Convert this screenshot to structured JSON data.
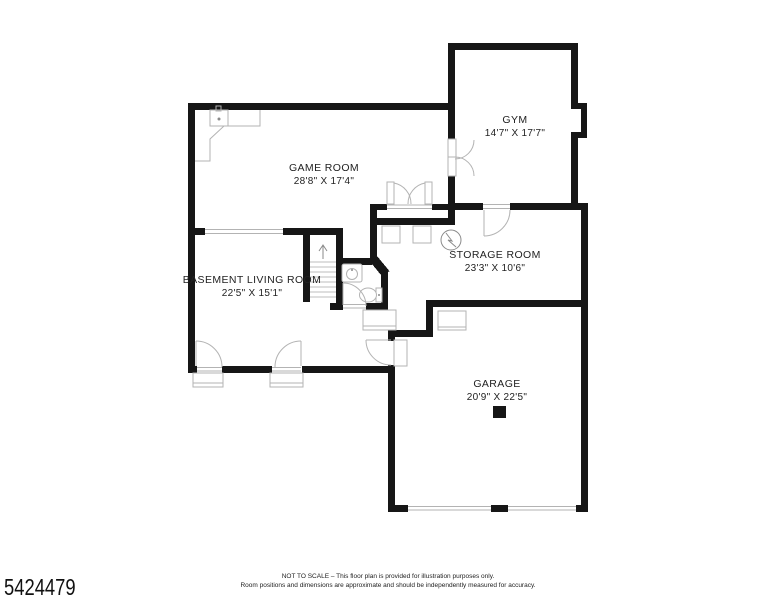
{
  "plan": {
    "title": "Basement / garage floor plan",
    "wall_color": "#161616",
    "fixture_color": "#b3b3b3",
    "rooms": [
      {
        "id": "gym",
        "name": "GYM",
        "dimensions": "14'7\" X 17'7\""
      },
      {
        "id": "game-room",
        "name": "GAME ROOM",
        "dimensions": "28'8\" X 17'4\""
      },
      {
        "id": "storage-room",
        "name": "STORAGE ROOM",
        "dimensions": "23'3\" X 10'6\""
      },
      {
        "id": "basement-living-room",
        "name": "BASEMENT LIVING ROOM",
        "dimensions": "22'5\" X 15'1\""
      },
      {
        "id": "garage",
        "name": "GARAGE",
        "dimensions": "20'9\" X 22'5\""
      }
    ]
  },
  "footer": {
    "listing_number": "5424479",
    "disclaimer_line1": "NOT TO SCALE – This floor plan is provided for illustration purposes only.",
    "disclaimer_line2": "Room positions and dimensions are approximate and should be independently measured for accuracy."
  }
}
